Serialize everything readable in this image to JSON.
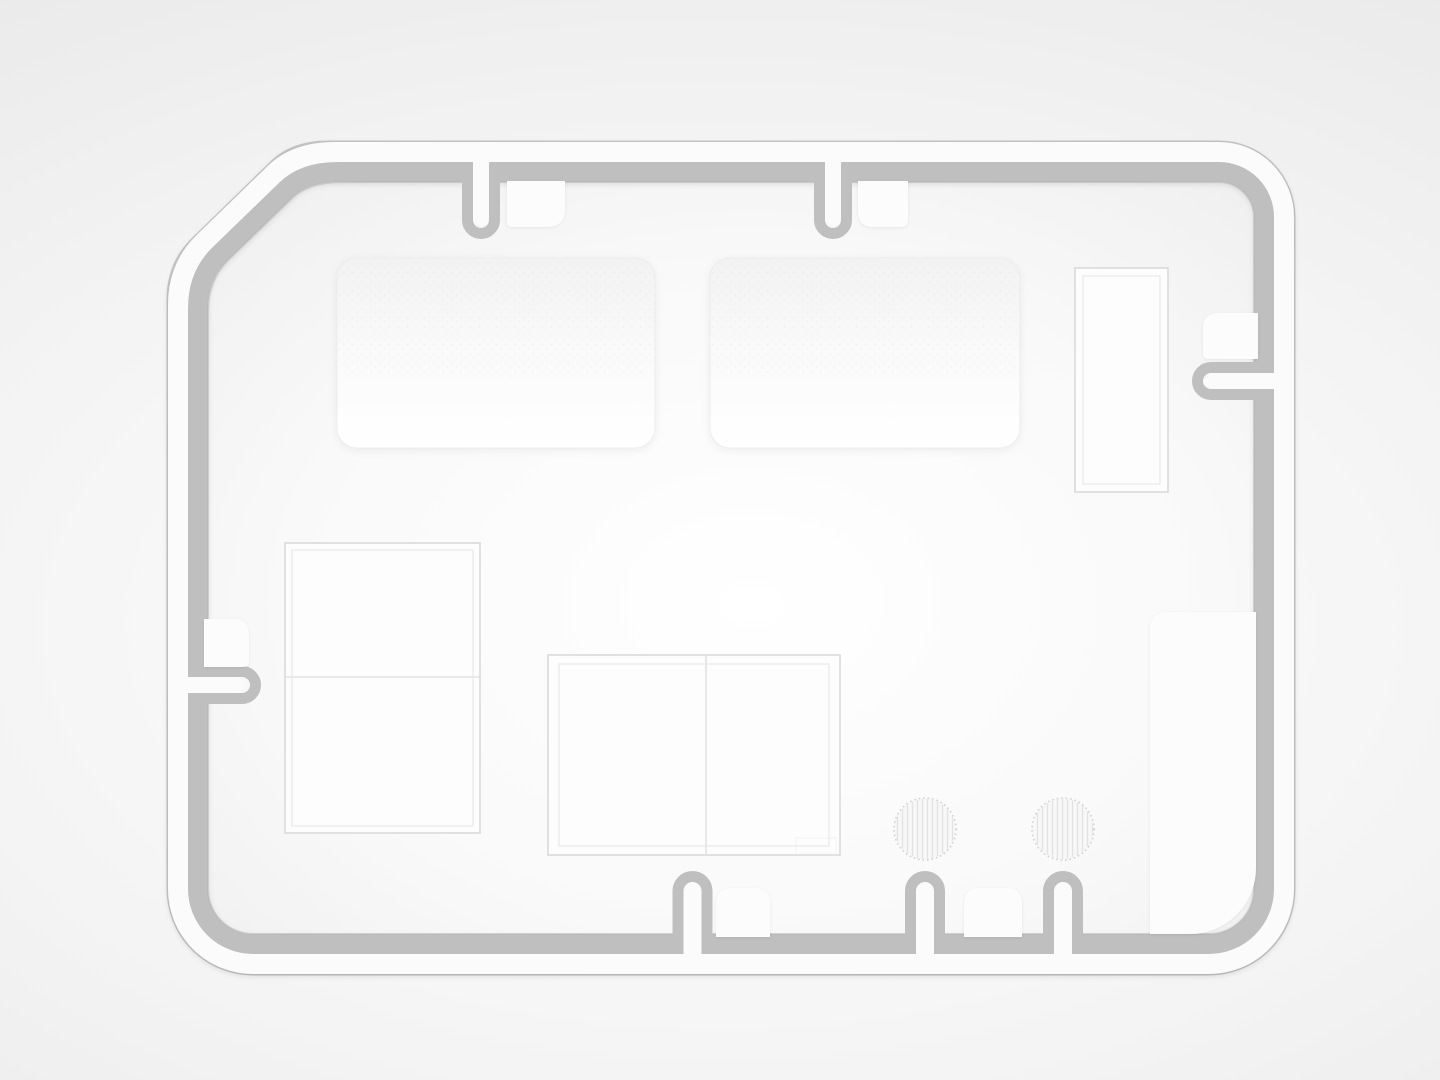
{
  "scene": {
    "kind": "monochrome 3d render, top view",
    "subject": "rounded rectangular gasket-channel outline with chamfered top-left corner, inner white panels, tabs and U-notches",
    "text_visible": ""
  },
  "colors": {
    "background_center": "#ffffff",
    "background_mid": "#f4f4f4",
    "background_outer": "#e2e2e2",
    "interior_center": "#ffffff",
    "interior_mid": "#f9f9f9",
    "interior_edge": "#efefef",
    "channel_highlight": "#fbfbfb",
    "channel_groove": "#bfbfbf",
    "outer_edge_line": "#bdbdbd",
    "inner_edge_line": "#b4b4b4",
    "tab_fill": "#fcfcfc",
    "panel_fill": "#fdfdfd",
    "panel_stroke": "#dadada",
    "panel_top_fill_start": "#f2f2f2",
    "panel_top_fill_mid": "#fafafa",
    "panel_top_fill_end": "#ffffff",
    "panel_top_stroke": "#ededed",
    "inner_frame_stroke": "#ececec",
    "divider_stroke": "#e6e6e6",
    "circle_fill": "#f8f8f8",
    "circle_stripe": "#dcdcdc",
    "circle_rim": "#cfcfcf",
    "speckle": "#b5b5b5"
  },
  "parts": {
    "outline_channel": 1,
    "notches_top": 2,
    "notches_right": 1,
    "notches_left": 1,
    "notches_bottom": 3,
    "tabs_top": 2,
    "tabs_right": 1,
    "tabs_left": 1,
    "tabs_bottom": 2,
    "large_rounded_panels_top": 2,
    "framed_rectangles": 3,
    "bottom_right_panel": 1,
    "hatched_circles": 2
  }
}
